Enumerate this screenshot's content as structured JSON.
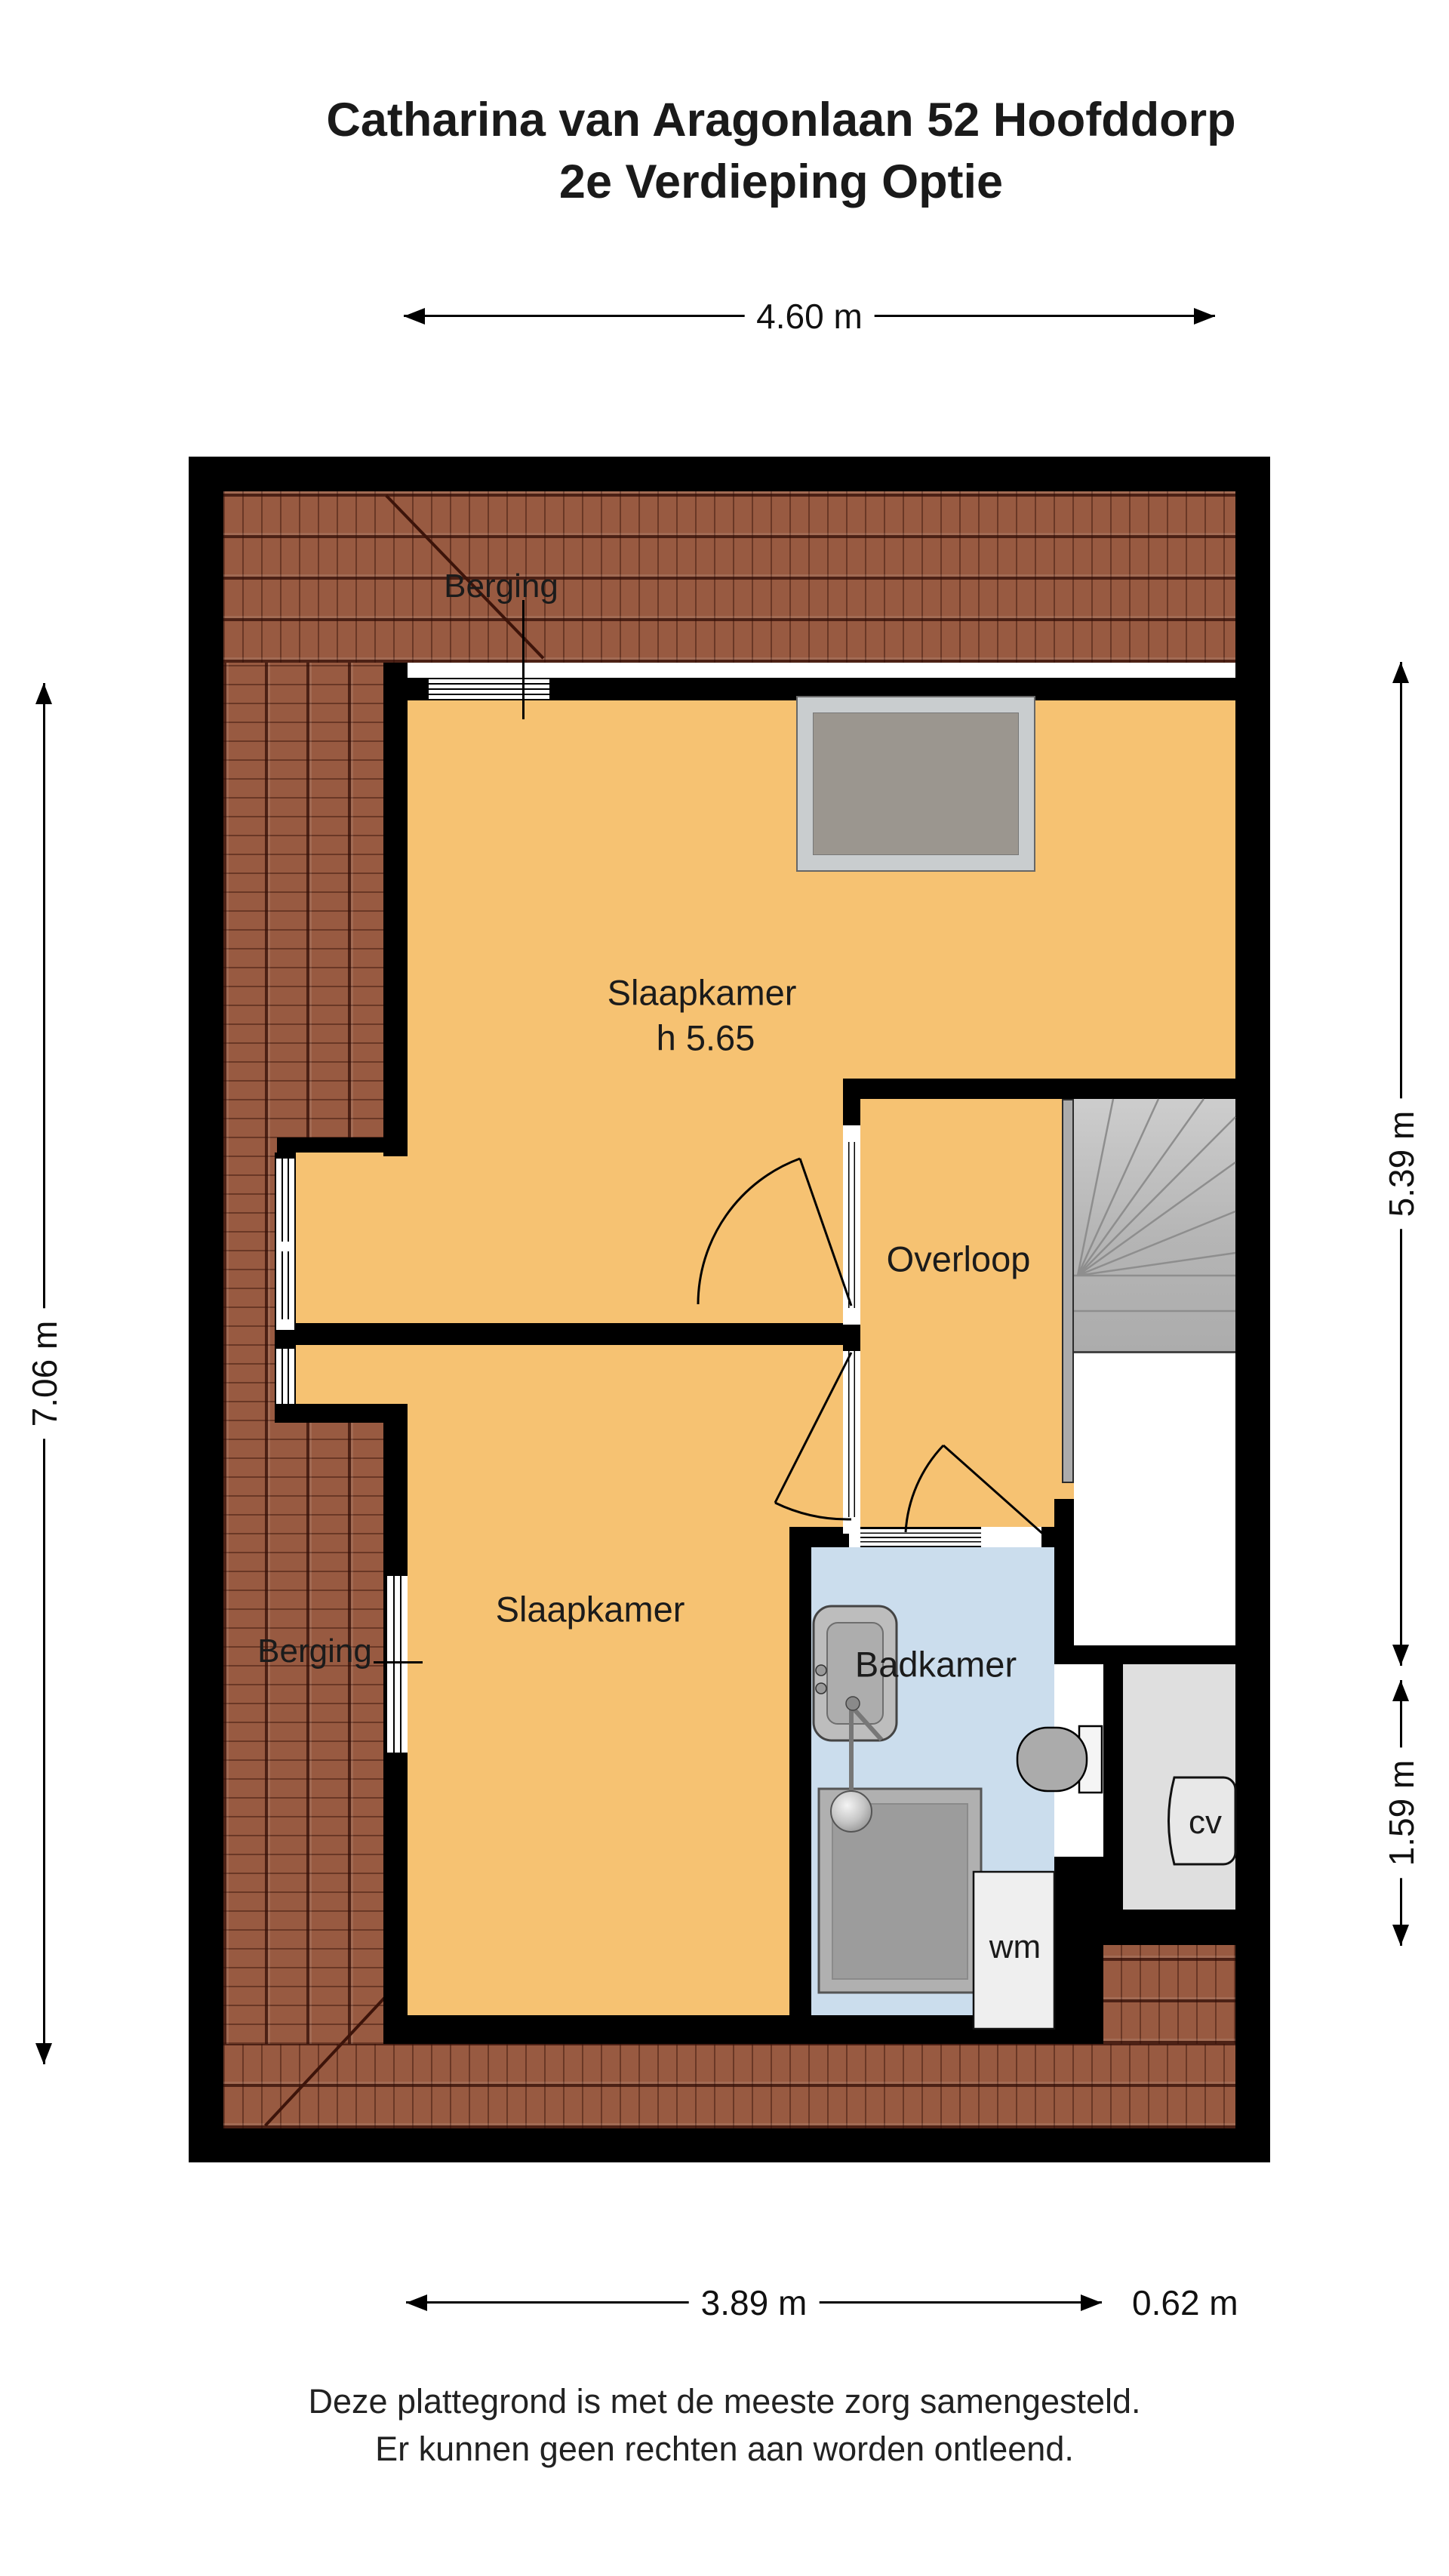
{
  "title": {
    "line1": "Catharina van Aragonlaan 52 Hoofddorp",
    "line2": "2e Verdieping Optie"
  },
  "dimensions": {
    "top": "4.60 m",
    "left": "7.06 m",
    "right_upper": "5.39 m",
    "right_lower": "1.59 m",
    "bottom": "3.89 m",
    "bottom_right": "0.62 m"
  },
  "rooms": {
    "berging_top": "Berging",
    "slaapkamer_top": {
      "name": "Slaapkamer",
      "height": "h 5.65"
    },
    "overloop": "Overloop",
    "slaapkamer_bottom": "Slaapkamer",
    "berging_left": "Berging",
    "badkamer": "Badkamer",
    "wm": "wm",
    "cv": "cv"
  },
  "footer": {
    "line1": "Deze plattegrond is met de meeste zorg samengesteld.",
    "line2": "Er kunnen geen rechten aan worden ontleend."
  },
  "colors": {
    "floor": "#F6C272",
    "bathroom_floor": "#CBDDED",
    "roof_tile": "#985A41",
    "wall": "#000000",
    "stairs": "#B5B5B5",
    "cv_floor": "#DFDFDF"
  }
}
